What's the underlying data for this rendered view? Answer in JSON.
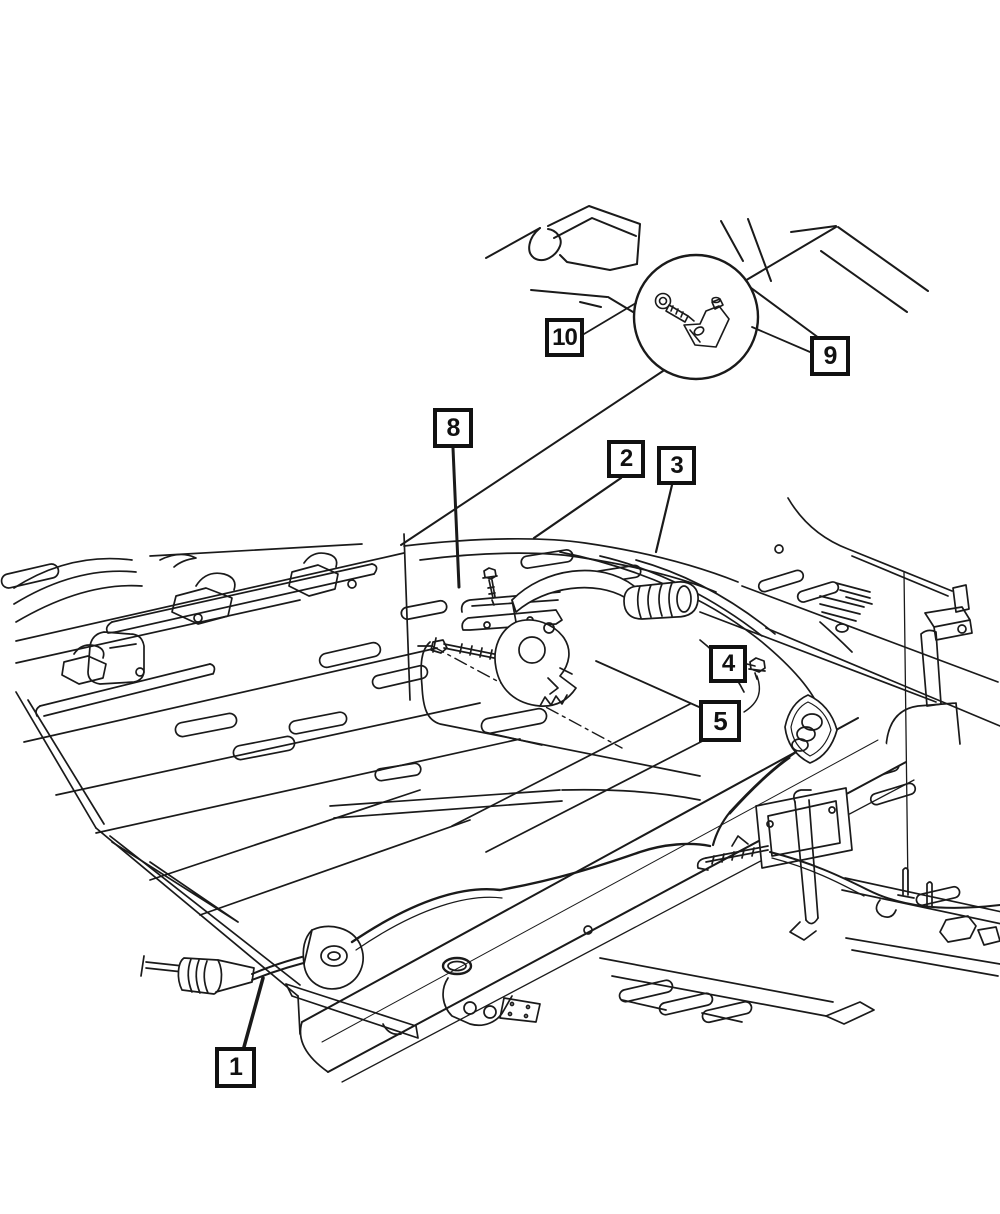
{
  "canvas": {
    "width": 1000,
    "height": 1214,
    "background": "#ffffff",
    "line_color": "#1a1a1a"
  },
  "figure": {
    "kind": "parking-brake-cable-parts-diagram"
  },
  "detail_circle": {
    "cx": 696,
    "cy": 317,
    "r": 62,
    "pointer": [
      [
        663,
        371
      ],
      [
        401,
        545
      ]
    ],
    "pointer_width": 2
  },
  "callouts": [
    {
      "label": "1",
      "box": {
        "x": 215,
        "y": 1047,
        "size": 41
      },
      "leader": [
        [
          244,
          1047
        ],
        [
          263,
          978
        ]
      ],
      "leader_width": 3.5
    },
    {
      "label": "2",
      "box": {
        "x": 607,
        "y": 440,
        "size": 38
      },
      "leader": [
        [
          621,
          478
        ],
        [
          534,
          538
        ]
      ],
      "leader_width": 2.2
    },
    {
      "label": "3",
      "box": {
        "x": 657,
        "y": 446,
        "size": 39
      },
      "leader": [
        [
          672,
          485
        ],
        [
          656,
          552
        ]
      ],
      "leader_width": 2.2
    },
    {
      "label": "4",
      "box": {
        "x": 709,
        "y": 645,
        "size": 38
      },
      "leader": [
        [
          747,
          664
        ],
        [
          755,
          666
        ]
      ],
      "leader_width": 1.6
    },
    {
      "label": "5",
      "box": {
        "x": 699,
        "y": 700,
        "size": 42
      },
      "leader": [
        [
          699,
          707
        ],
        [
          596,
          661
        ]
      ],
      "leader_width": 1.8
    },
    {
      "label": "8",
      "box": {
        "x": 433,
        "y": 408,
        "size": 40
      },
      "leader": [
        [
          453,
          448
        ],
        [
          459,
          587
        ]
      ],
      "leader_width": 3
    },
    {
      "label": "9",
      "box": {
        "x": 810,
        "y": 336,
        "size": 40
      },
      "leader": [
        [
          810,
          352
        ],
        [
          752,
          327
        ]
      ],
      "leader_width": 1.8
    },
    {
      "label": "10",
      "box": {
        "x": 545,
        "y": 318,
        "size": 39
      },
      "leader": [
        [
          584,
          334
        ],
        [
          636,
          303
        ]
      ],
      "leader_width": 1.8
    }
  ]
}
